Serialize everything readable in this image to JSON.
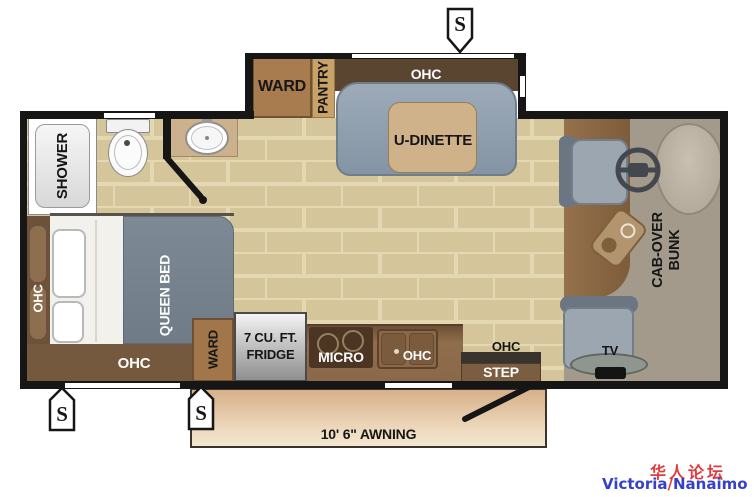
{
  "labels": {
    "speaker": "S",
    "shower": "SHOWER",
    "slideout": {
      "ward": "WARD",
      "pantry": "PANTRY",
      "ohc": "OHC",
      "dinette": "U-DINETTE"
    },
    "bed": {
      "ohc_side": "OHC",
      "queen": "QUEEN BED",
      "ohc_bottom": "OHC"
    },
    "kitchen": {
      "ward": "WARD",
      "fridge_line1": "7 CU. FT.",
      "fridge_line2": "FRIDGE",
      "micro": "MICRO",
      "ohc": "OHC"
    },
    "entry": {
      "ohc": "OHC",
      "step": "STEP"
    },
    "cab": {
      "bunk_line1": "CAB-OVER",
      "bunk_line2": "BUNK",
      "tv": "TV"
    },
    "awning": "10' 6\" AWNING"
  },
  "watermark": {
    "cn": "华人论坛",
    "en_left": "Victoria",
    "slash": "/",
    "en_right": "Nanaimo"
  },
  "colors": {
    "wall": "#161616",
    "floor": "#d4c69a",
    "floor_grout": "#e4d8b2",
    "cabinet_dark": "#5a4531",
    "wood_mid": "#8a684a",
    "sofa_gray": "#93a2b1",
    "bed_gray": "#76828e",
    "table_tan": "#cfb28a",
    "awning_tan": "#d6b089",
    "watermark_red": "#e23b3b",
    "watermark_blue": "#3541c8"
  }
}
